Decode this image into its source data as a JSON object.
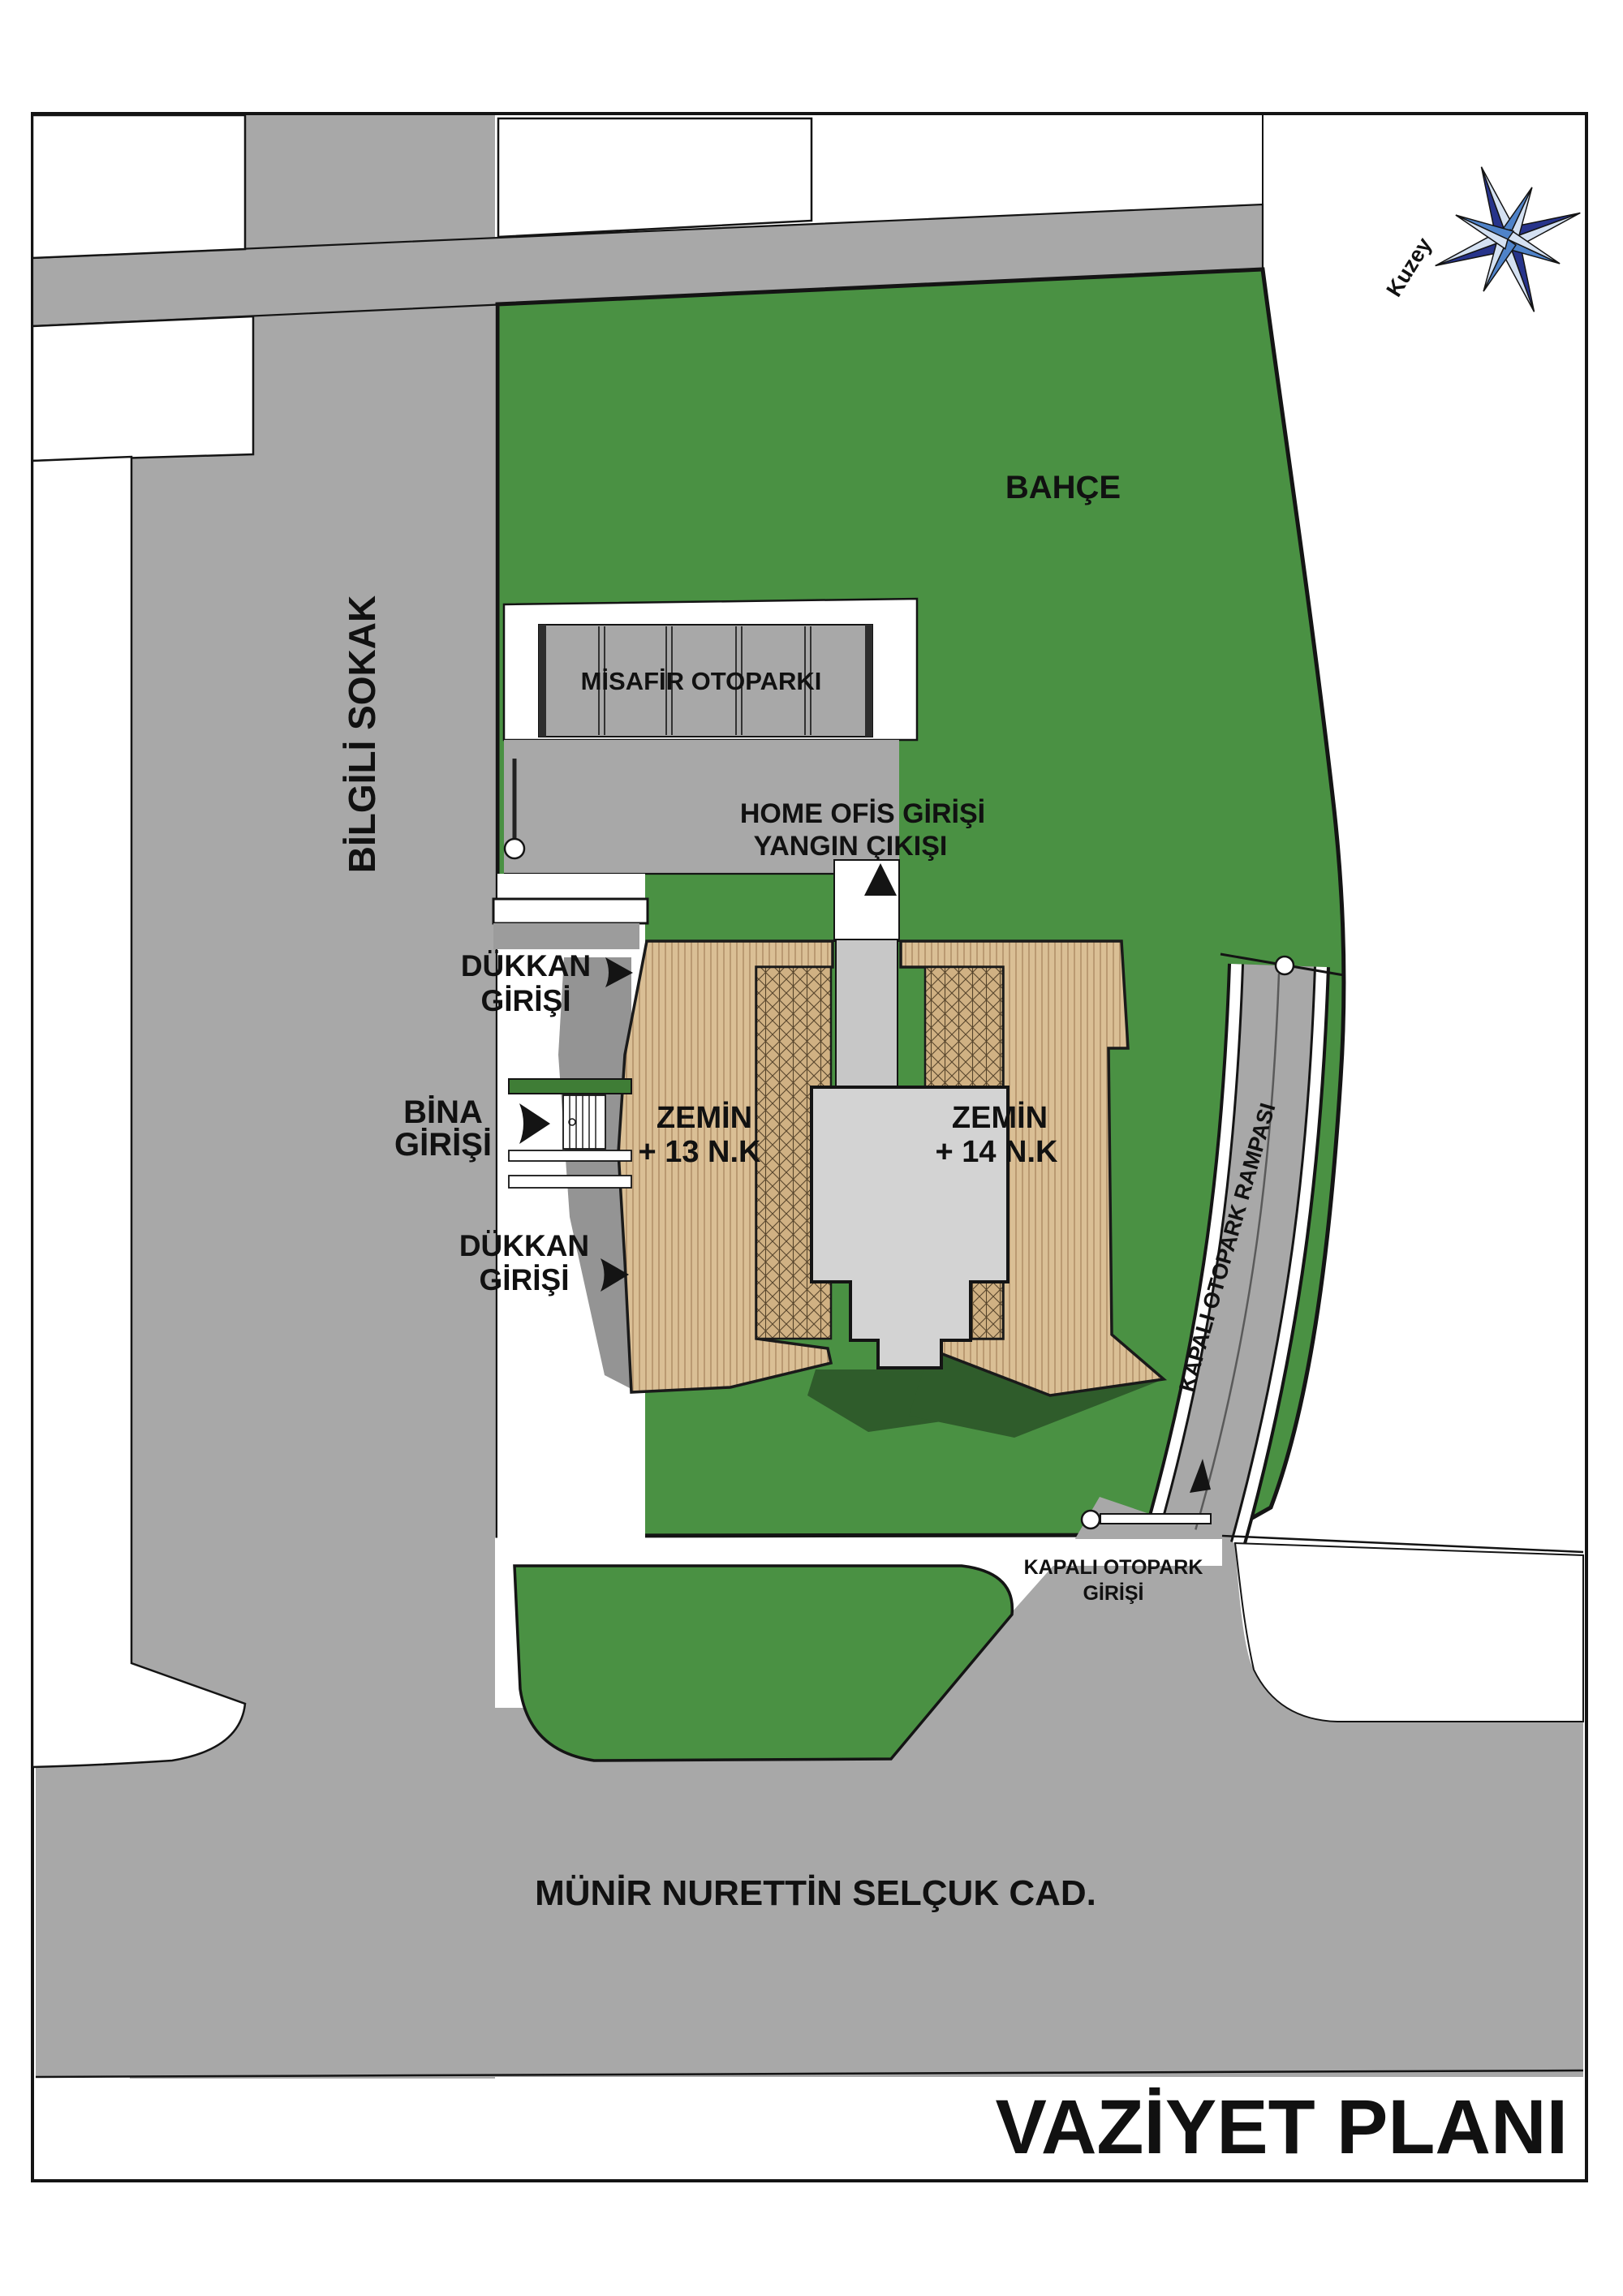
{
  "title": {
    "label": "VAZİYET PLANI"
  },
  "compass": {
    "north_label": "Kuzey"
  },
  "streets": {
    "west": "BİLGİLİ SOKAK",
    "south": "MÜNİR NURETTİN SELÇUK CAD."
  },
  "site": {
    "garden_label": "BAHÇE",
    "guest_parking_label": "MİSAFİR OTOPARKI",
    "home_office_entrance_label": "HOME OFİS GİRİŞİ",
    "fire_exit_label": "YANGIN ÇIKIŞI",
    "shop_entrance_1": {
      "line1": "DÜKKAN",
      "line2": "GİRİŞİ"
    },
    "building_entrance": {
      "line1": "BİNA",
      "line2": "GİRİŞİ"
    },
    "shop_entrance_2": {
      "line1": "DÜKKAN",
      "line2": "GİRİŞİ"
    },
    "block_left": {
      "line1": "ZEMİN",
      "line2": "+ 13 N.K"
    },
    "block_right": {
      "line1": "ZEMİN",
      "line2": "+ 14 N.K"
    },
    "parking_ramp_label": "KAPALI OTOPARK RAMPASI",
    "parking_entrance": {
      "line1": "KAPALI OTOPARK",
      "line2": "GİRİŞİ"
    }
  },
  "colors": {
    "road": "#a8a8a8",
    "garden": "#4a9143",
    "garden_shadow": "#2f5c2b",
    "wood": "#dabf95",
    "wood_stripe": "#b3916a",
    "hatch_bg": "#d0b183",
    "core": "#d3d3d3",
    "corridor": "#c7c7c7",
    "shadow_gray": "#949494",
    "outline": "#141414",
    "compass_dark": "#27348b",
    "compass_light": "#d4e1f2",
    "compass_mid": "#4f83c9"
  }
}
